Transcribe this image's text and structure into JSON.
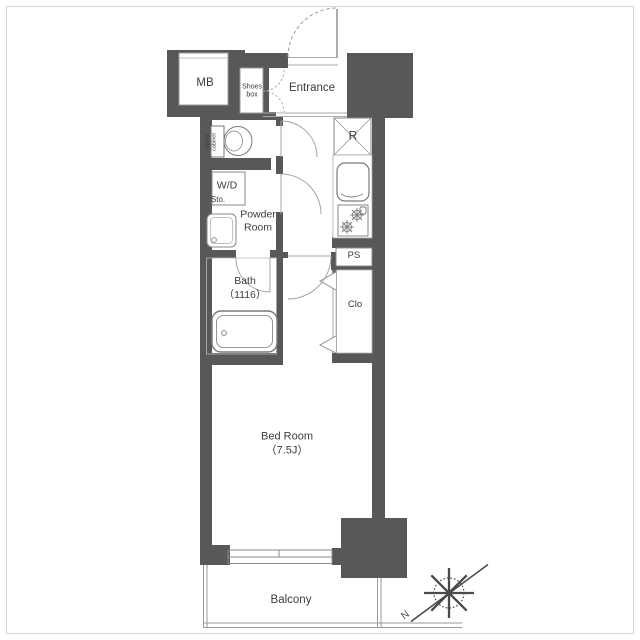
{
  "colors": {
    "wall": "#57585a",
    "fixture_line": "#7a7a7a",
    "door_arc": "#a5a5a5",
    "text": "#3c3c3c"
  },
  "labels": {
    "mb": "MB",
    "shoes_box": "Shoes\nbox",
    "entrance": "Entrance",
    "upper_cabinet": "Upper\ncabinet",
    "wd": "W/D",
    "sto": "Sto.",
    "powder_room": "Powder\nRoom",
    "bath": "Bath\n（1116）",
    "refrigerator": "R",
    "pipe_space": "PS",
    "closet": "Clo",
    "bed_room": "Bed Room\n（7.5J）",
    "balcony": "Balcony",
    "north": "N"
  }
}
